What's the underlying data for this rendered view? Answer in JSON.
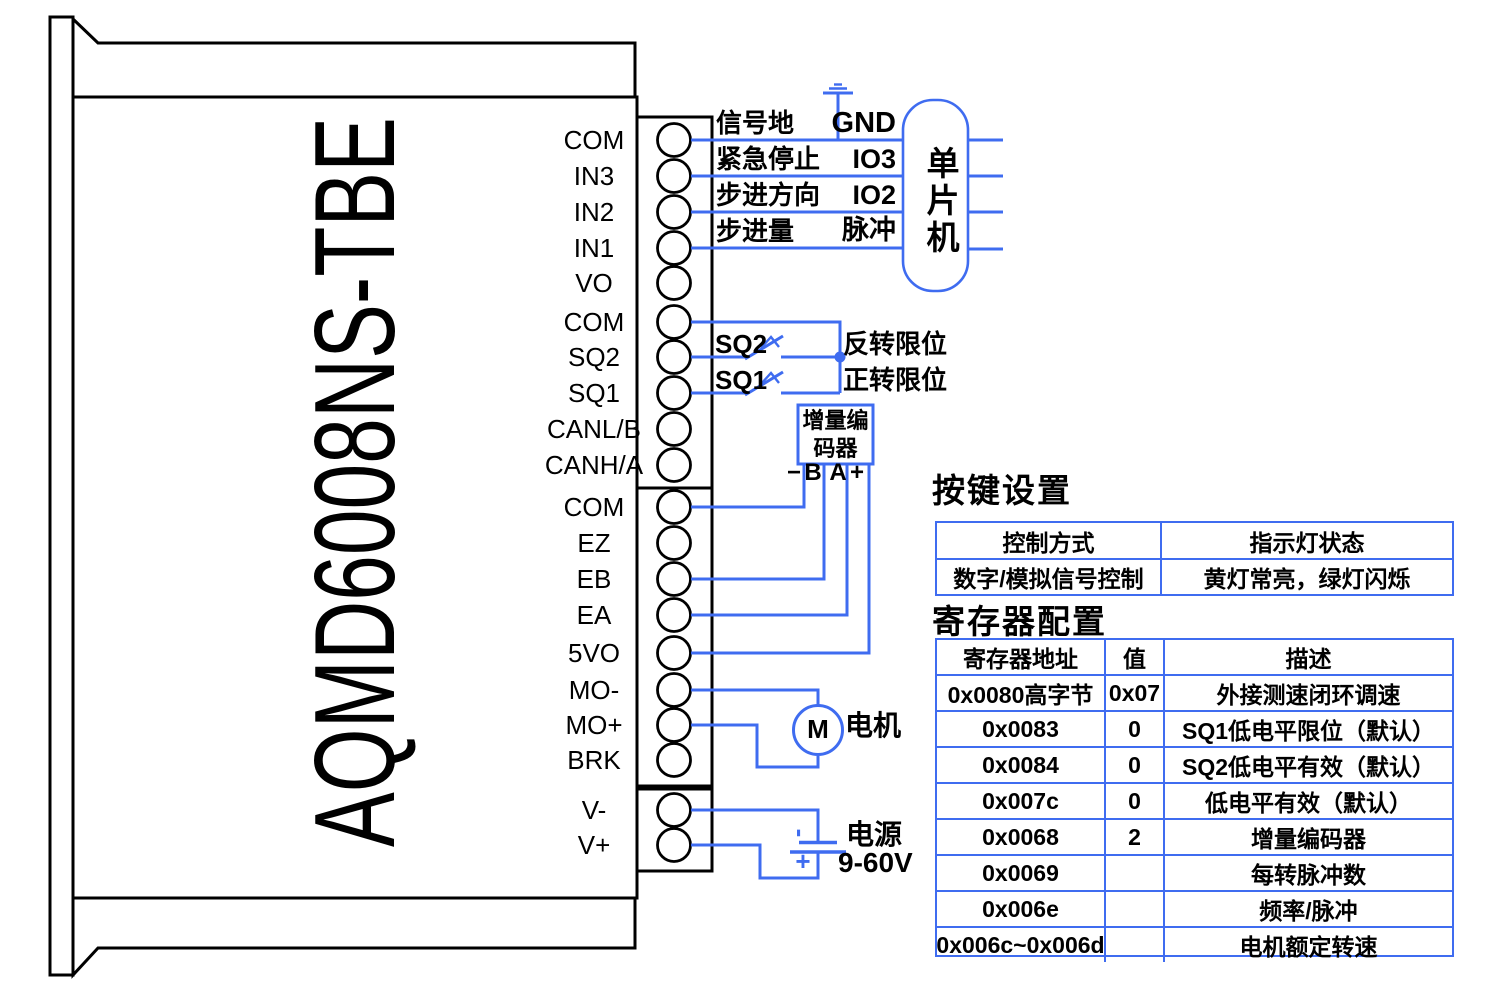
{
  "device": {
    "model": "AQMD6008NS-TBE",
    "terminal_groups": [
      {
        "pins": [
          "COM",
          "IN3",
          "IN2",
          "IN1",
          "VO",
          "COM",
          "SQ2",
          "SQ1",
          "CANL/B",
          "CANH/A"
        ]
      },
      {
        "pins": [
          "COM",
          "EZ",
          "EB",
          "EA",
          "5VO",
          "MO-",
          "MO+",
          "BRK"
        ]
      },
      {
        "pins": [
          "V-",
          "V+"
        ]
      }
    ]
  },
  "wiring": {
    "signal_labels": [
      "信号地",
      "紧急停止",
      "步进方向",
      "步进量"
    ],
    "mcu": {
      "label": "单片机",
      "pins": [
        "GND",
        "IO3",
        "IO2",
        "脉冲"
      ]
    },
    "limit_switches": [
      {
        "name": "SQ2",
        "function": "反转限位"
      },
      {
        "name": "SQ1",
        "function": "正转限位"
      }
    ],
    "encoder": {
      "name_line1": "增量编",
      "name_line2": "码器",
      "pins": [
        "−",
        "B",
        "A",
        "+"
      ]
    },
    "motor": {
      "symbol": "M",
      "label": "电机"
    },
    "power": {
      "label": "电源",
      "voltage": "9-60V",
      "positive": "+",
      "negative": "-"
    }
  },
  "key_settings_table": {
    "title": "按键设置",
    "headers": [
      "控制方式",
      "指示灯状态"
    ],
    "rows": [
      [
        "数字/模拟信号控制",
        "黄灯常亮，绿灯闪烁"
      ]
    ]
  },
  "register_table": {
    "title": "寄存器配置",
    "headers": [
      "寄存器地址",
      "值",
      "描述"
    ],
    "rows": [
      [
        "0x0080高字节",
        "0x07",
        "外接测速闭环调速"
      ],
      [
        "0x0083",
        "0",
        "SQ1低电平限位（默认）"
      ],
      [
        "0x0084",
        "0",
        "SQ2低电平有效（默认）"
      ],
      [
        "0x007c",
        "0",
        "低电平有效（默认）"
      ],
      [
        "0x0068",
        "2",
        "增量编码器"
      ],
      [
        "0x0069",
        "",
        "每转脉冲数"
      ],
      [
        "0x006e",
        "",
        "频率/脉冲"
      ],
      [
        "0x006c~0x006d",
        "",
        "电机额定转速"
      ]
    ]
  },
  "colors": {
    "wire_blue": "#3f6cf0",
    "outline_black": "#000000"
  }
}
